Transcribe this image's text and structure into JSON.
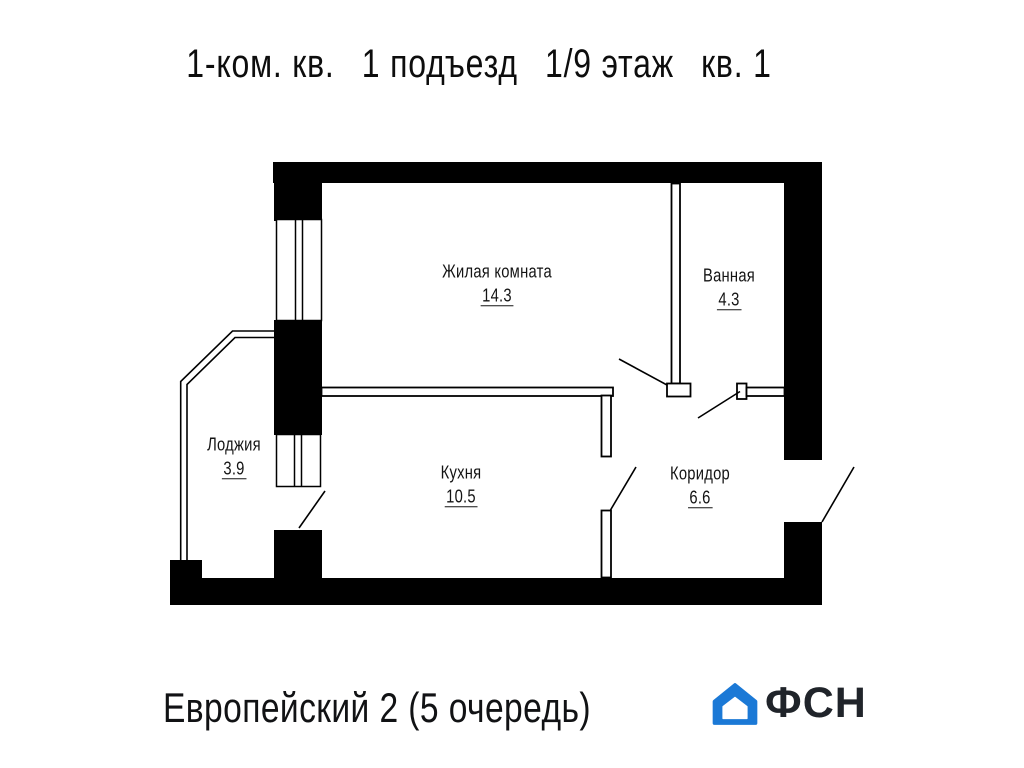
{
  "title": {
    "segments": [
      "1-ком. кв.",
      "1 подъезд",
      "1/9 этаж",
      "кв. 1"
    ]
  },
  "rooms": [
    {
      "name": "Жилая комната",
      "area": "14.3"
    },
    {
      "name": "Ванная",
      "area": "4.3"
    },
    {
      "name": "Кухня",
      "area": "10.5"
    },
    {
      "name": "Коридор",
      "area": "6.6"
    },
    {
      "name": "Лоджия",
      "area": "3.9"
    }
  ],
  "footer": {
    "project": "Европейский 2 (5 очередь)",
    "logo_text": "ФСН"
  },
  "colors": {
    "wall": "#000000",
    "line": "#000000",
    "logo_blue": "#1b79d6",
    "logo_text": "#20242a"
  }
}
